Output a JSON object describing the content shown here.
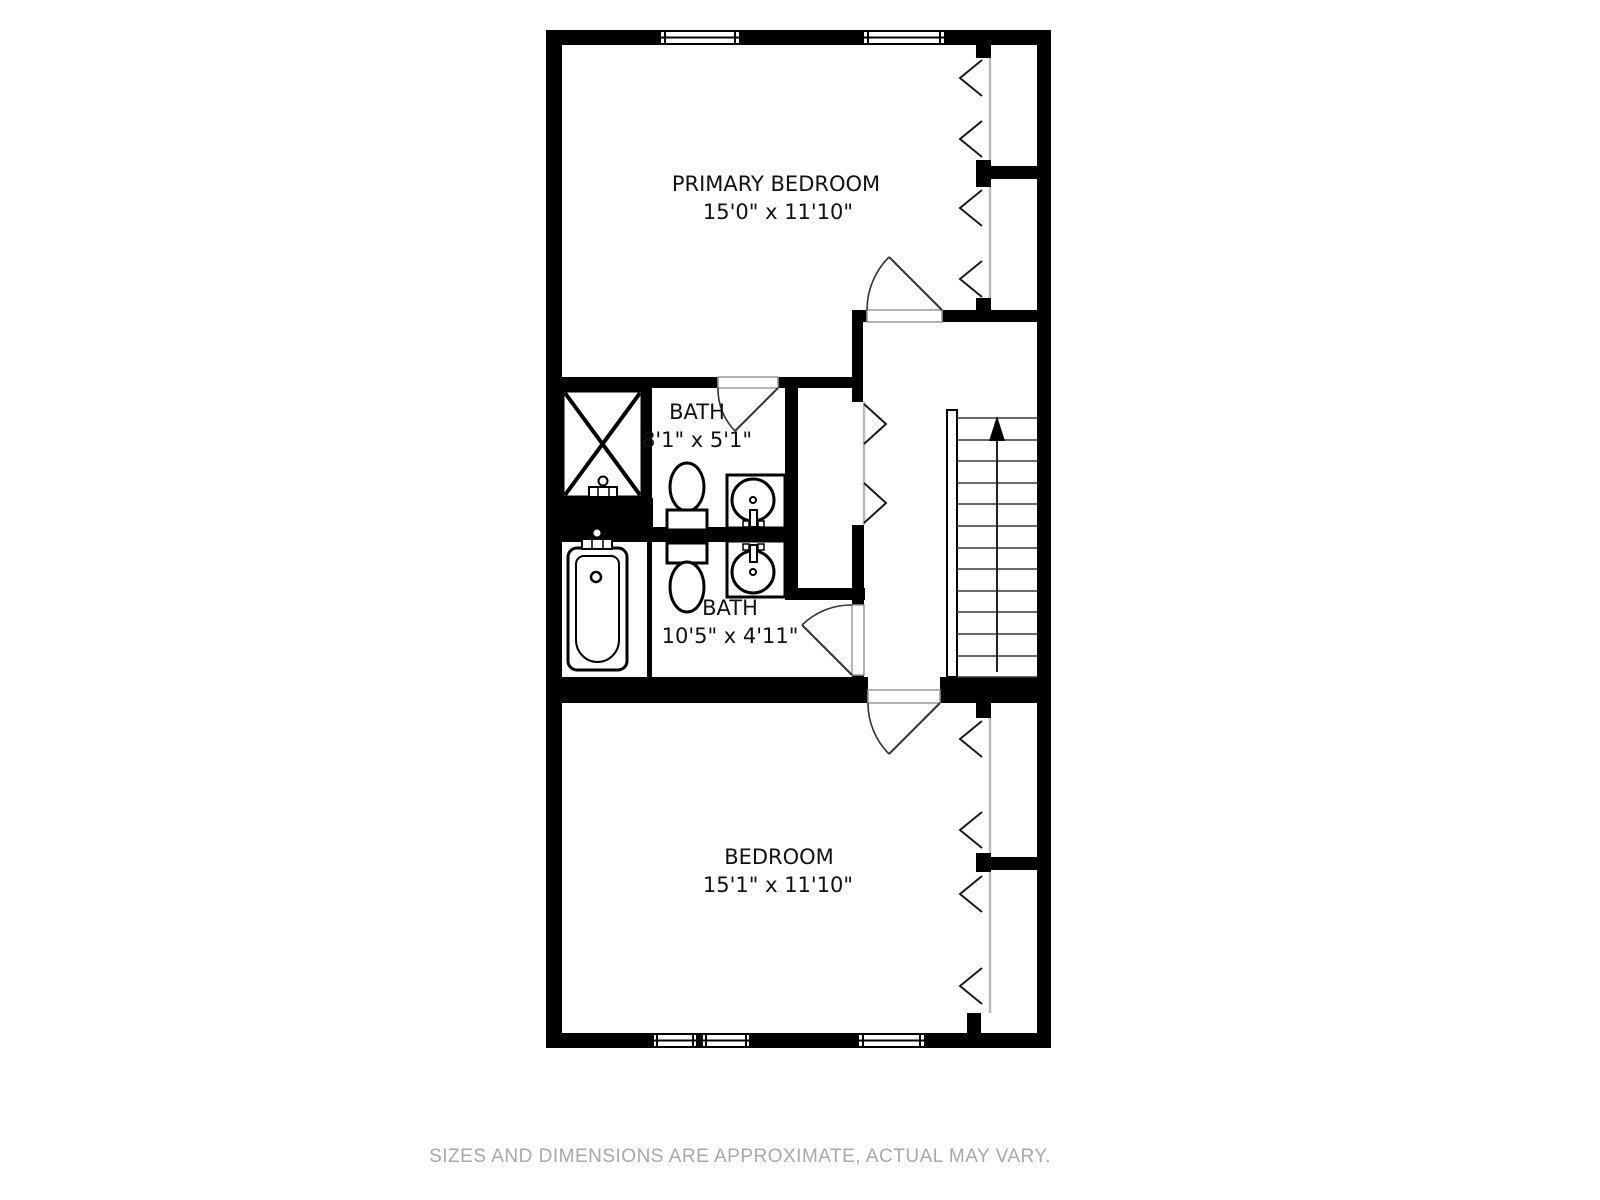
{
  "rooms": {
    "primary_bedroom": {
      "label": "PRIMARY BEDROOM",
      "dims": "15'0\" x 11'10\""
    },
    "bath_top": {
      "label": "BATH",
      "dims": "8'1\" x 5'1\""
    },
    "bath_bottom": {
      "label": "BATH",
      "dims": "10'5\" x 4'11\""
    },
    "bedroom": {
      "label": "BEDROOM",
      "dims": "15'1\" x 11'10\""
    }
  },
  "stairs": {
    "direction": "up"
  },
  "footer": {
    "text": "SIZES AND DIMENSIONS ARE APPROXIMATE, ACTUAL MAY VARY."
  },
  "colors": {
    "wall": "#000000",
    "label_text": "#111111",
    "footer_text": "#a8a8a8",
    "closet_front_line": "#b9b9b9",
    "background": "#ffffff"
  }
}
